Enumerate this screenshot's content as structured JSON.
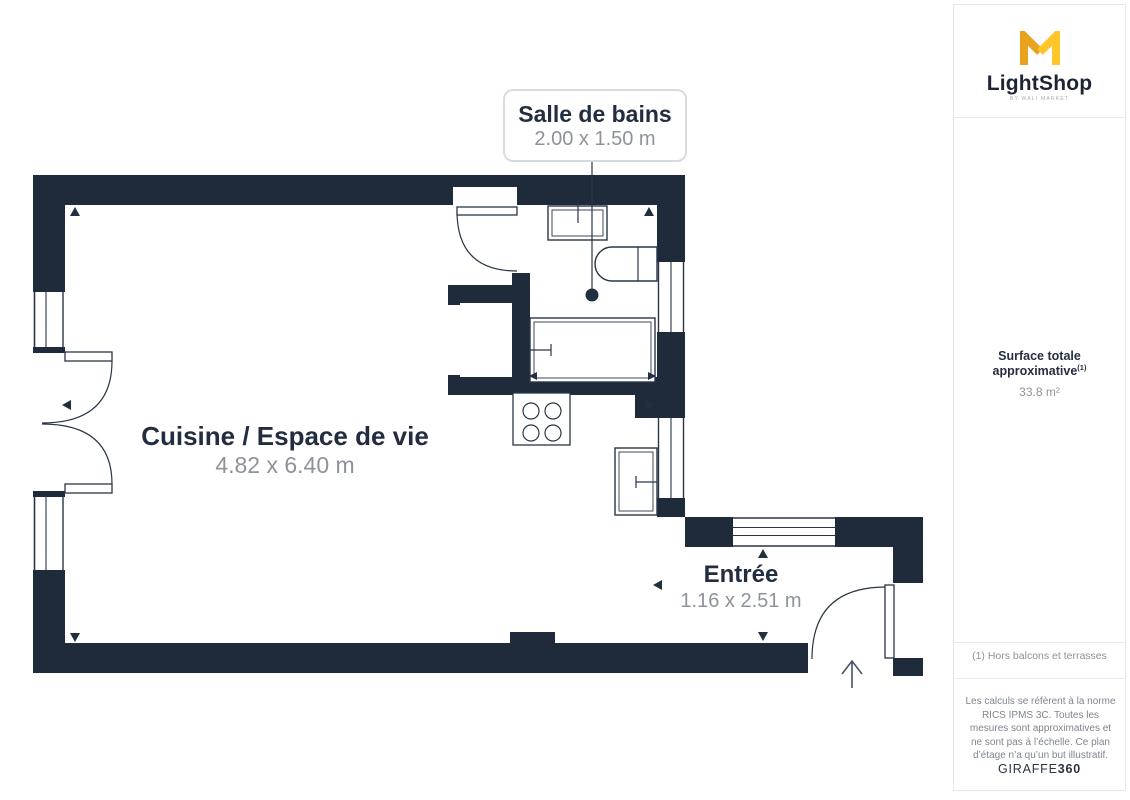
{
  "plan": {
    "rooms": [
      {
        "name": "Salle de bains",
        "dims": "2.00 x 1.50 m"
      },
      {
        "name": "Cuisine / Espace de vie",
        "dims": "4.82 x 6.40 m"
      },
      {
        "name": "Entrée",
        "dims": "1.16 x 2.51 m"
      }
    ]
  },
  "sidebar": {
    "logo": {
      "text": "LightShop",
      "tagline": "BY WALI MARKET"
    },
    "surface": {
      "label": "Surface totale approximative",
      "marker": "(1)",
      "value": "33.8 m²"
    },
    "footnote": "(1) Hors balcons et terrasses",
    "disclaimer": "Les calculs se réfèrent à la norme RICS IPMS 3C. Toutes les mesures sont approximatives et ne sont pas à l’échelle. Ce plan d’étage n’a qu’un but illustratif.",
    "credit": {
      "brand": "GIRAFFE",
      "suffix": "360"
    }
  },
  "colors": {
    "wall": "#1F2B3B",
    "room_title": "#222E40",
    "dimension_text": "#8E939B",
    "logo_gold": "#E9A31E",
    "logo_yellow": "#FFC62A"
  }
}
